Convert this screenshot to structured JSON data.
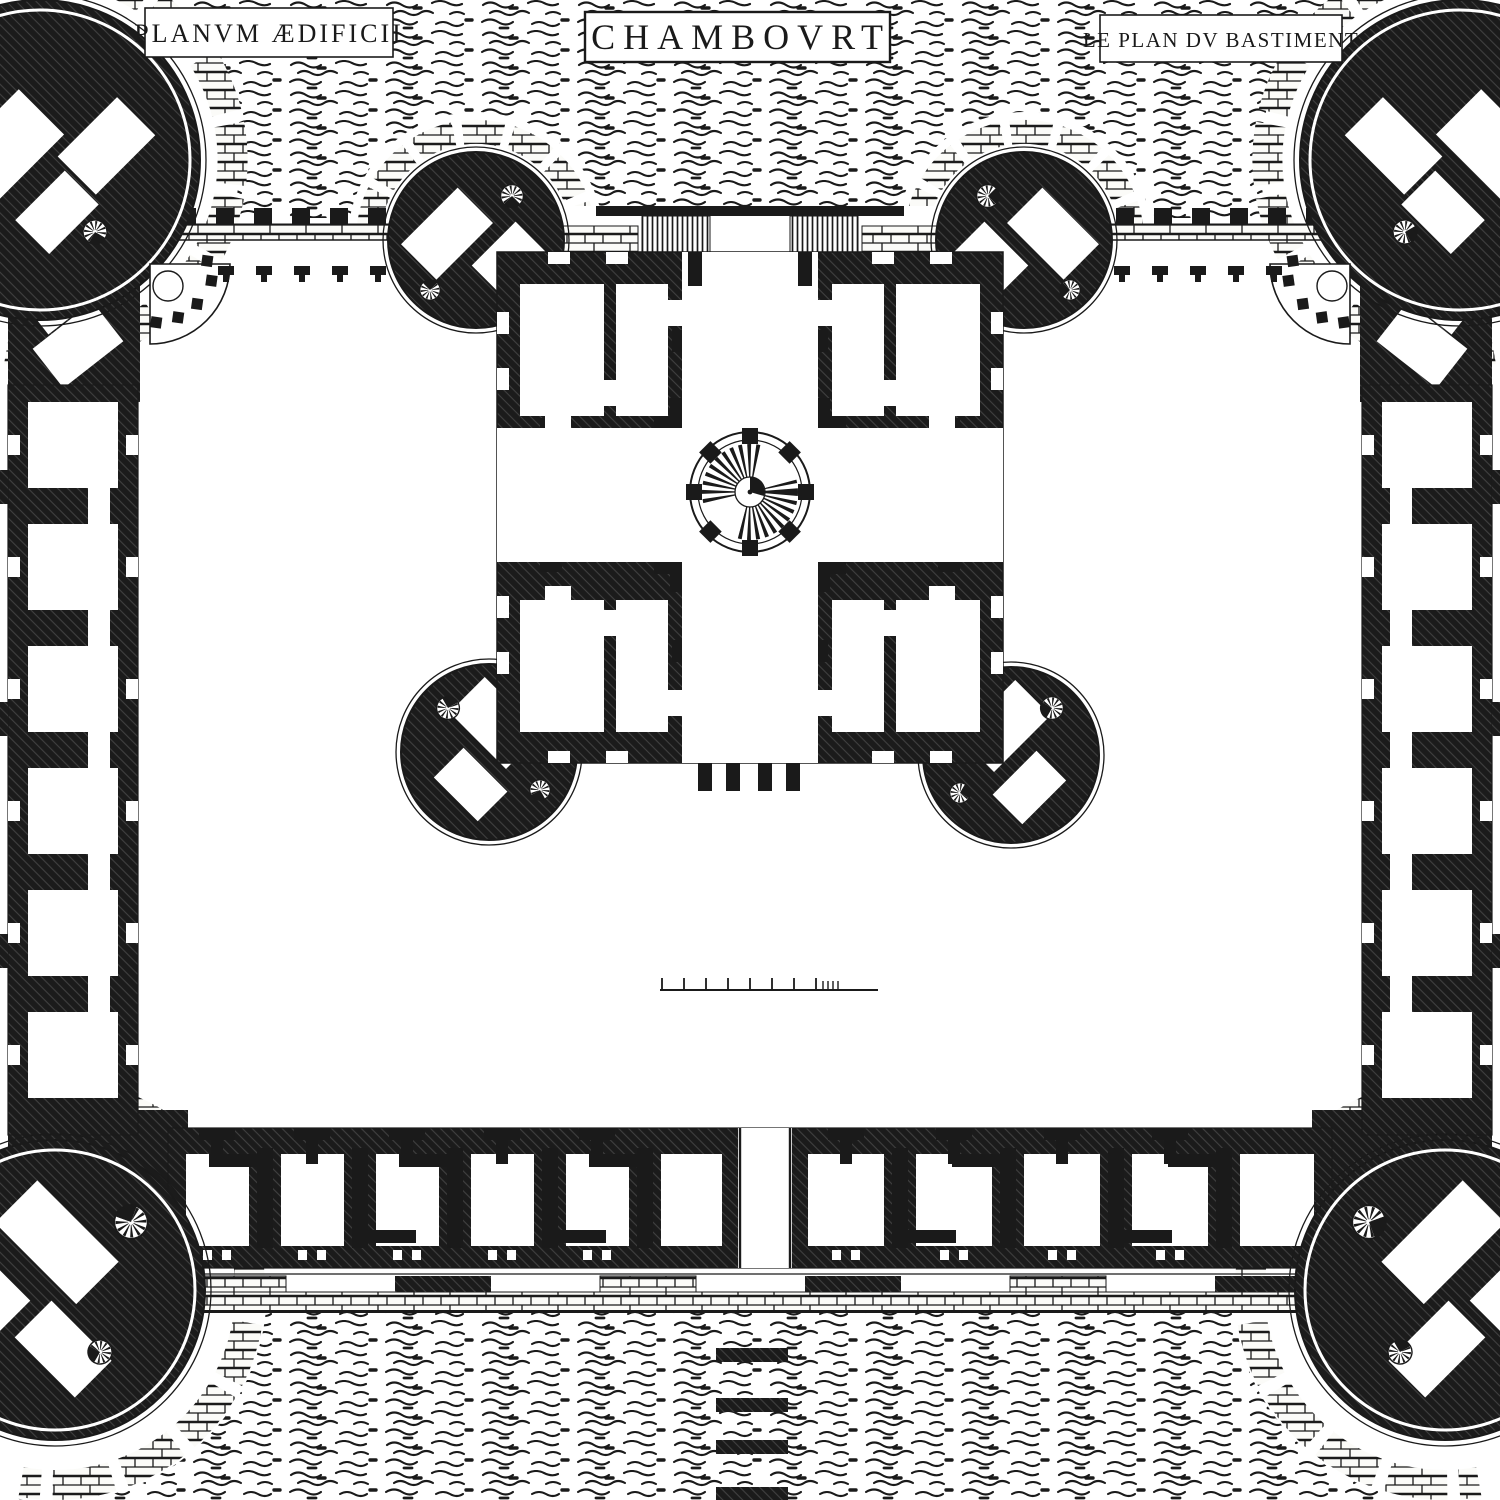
{
  "plate": {
    "label_left": "PLANVM ÆDIFICII",
    "title": "CHAMBOVRT",
    "label_right": "LE PLAN DV BASTIMENT"
  },
  "colors": {
    "ink": "#1a1a1a",
    "paper": "#ffffff"
  },
  "scale_bar": {
    "major_ticks": 8,
    "minor_ticks": 4
  },
  "bridge": {
    "pier_count": 4
  }
}
